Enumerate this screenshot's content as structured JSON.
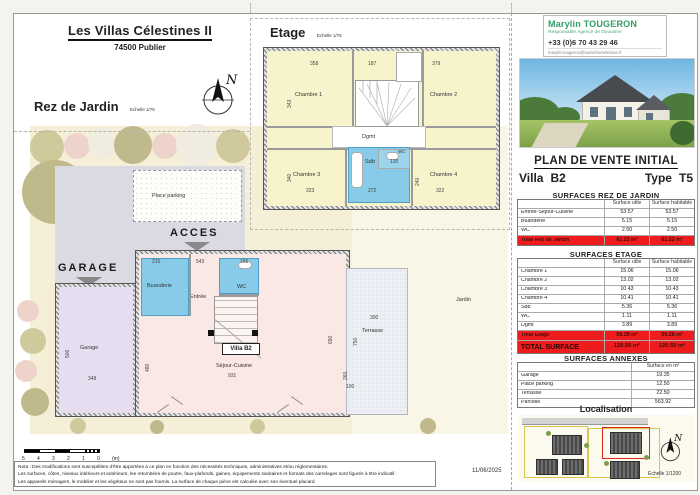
{
  "title": {
    "main": "Les Villas Célestines II",
    "sub": "74500 Publier"
  },
  "agent": {
    "name": "Marylin TOUGERON",
    "role": "Responsable Agence de Douvaine",
    "phone": "+33 (0)6 70 43 29 46",
    "email": "marylin.tougeron@sweethomeleman.fr"
  },
  "sale": {
    "heading": "PLAN DE VENTE INITIAL",
    "villa_label": "Villa",
    "villa_value": "B2",
    "type_label": "Type",
    "type_value": "T5"
  },
  "plans": {
    "rez": {
      "title": "Rez de Jardin",
      "scale": "Echelle 1/75"
    },
    "etage": {
      "title": "Etage",
      "scale": "Echelle 1/75"
    }
  },
  "etage": {
    "rooms": {
      "c1": "Chambre 1",
      "c2": "Chambre 2",
      "c3": "Chambre 3",
      "c4": "Chambre 4",
      "dgmt": "Dgmt",
      "sdb": "Sdb",
      "wc": "WC"
    },
    "dims": [
      {
        "t": "358",
        "x": 310,
        "y": 62
      },
      {
        "t": "187",
        "x": 368,
        "y": 62
      },
      {
        "t": "379",
        "x": 432,
        "y": 62
      },
      {
        "t": "323",
        "x": 306,
        "y": 189
      },
      {
        "t": "272",
        "x": 368,
        "y": 189
      },
      {
        "t": "322",
        "x": 436,
        "y": 189
      },
      {
        "t": "130",
        "x": 390,
        "y": 160
      },
      {
        "t": "343",
        "x": 288,
        "y": 108,
        "v": 1
      },
      {
        "t": "340",
        "x": 288,
        "y": 182,
        "v": 1
      },
      {
        "t": "240",
        "x": 416,
        "y": 186,
        "v": 1
      }
    ]
  },
  "rez": {
    "rooms": {
      "buanderie": "Buanderie",
      "entree": "Entrée",
      "wc": "WC",
      "garage": "Garage",
      "villa": "Villa B2",
      "sejour": "Séjour-Cuisine",
      "terrasse": "Terrasse",
      "jardin": "Jardin",
      "parking": "Place parking"
    },
    "callouts": {
      "acces": "ACCES",
      "garage": "GARAGE"
    },
    "dims": [
      {
        "t": "215",
        "x": 152,
        "y": 260
      },
      {
        "t": "543",
        "x": 196,
        "y": 260
      },
      {
        "t": "166",
        "x": 240,
        "y": 260
      },
      {
        "t": "931",
        "x": 228,
        "y": 374
      },
      {
        "t": "480",
        "x": 146,
        "y": 372,
        "v": 1
      },
      {
        "t": "690",
        "x": 329,
        "y": 344,
        "v": 1
      },
      {
        "t": "506",
        "x": 66,
        "y": 358,
        "v": 1
      },
      {
        "t": "348",
        "x": 88,
        "y": 377
      },
      {
        "t": "300",
        "x": 370,
        "y": 316
      },
      {
        "t": "750",
        "x": 354,
        "y": 346,
        "v": 1
      },
      {
        "t": "260",
        "x": 344,
        "y": 380,
        "v": 1
      },
      {
        "t": "100",
        "x": 346,
        "y": 385
      }
    ]
  },
  "compass": {
    "n": "N"
  },
  "tables": [
    {
      "title": "SURFACES REZ DE JARDIN",
      "headers": [
        "",
        "Surface utile",
        "Surface habitable"
      ],
      "rows": [
        [
          "Entrée-Séjour-Cuisine",
          "53.57",
          "53.57"
        ],
        [
          "Buanderie",
          "5.15",
          "5.15"
        ],
        [
          "WC",
          "2.50",
          "2.50"
        ]
      ],
      "totals": [
        {
          "cells": [
            "Total Rez de Jardin",
            "61.22 m²",
            "61.22 m²"
          ],
          "grand": false
        }
      ]
    },
    {
      "title": "SURFACES ETAGE",
      "headers": [
        "",
        "Surface utile",
        "Surface habitable"
      ],
      "rows": [
        [
          "Chambre 1",
          "15.06",
          "15.06"
        ],
        [
          "Chambre 2",
          "13.02",
          "13.02"
        ],
        [
          "Chambre 3",
          "10.43",
          "10.43"
        ],
        [
          "Chambre 4",
          "10.41",
          "10.41"
        ],
        [
          "Sdb",
          "5.36",
          "5.36"
        ],
        [
          "WC",
          "1.11",
          "1.11"
        ],
        [
          "Dgmt",
          "3.89",
          "3.89"
        ]
      ],
      "totals": [
        {
          "cells": [
            "Total Etage",
            "59.28 m²",
            "59.28 m²"
          ],
          "grand": false
        },
        {
          "cells": [
            "TOTAL SURFACE",
            "120.50 m²",
            "120.50 m²"
          ],
          "grand": true
        }
      ]
    },
    {
      "title": "SURFACES ANNEXES",
      "headers": [
        "",
        "Surface en m²"
      ],
      "rows": [
        [
          "Garage",
          "19.35"
        ],
        [
          "Place parking",
          "12.50"
        ],
        [
          "Terrasse",
          "22.50"
        ],
        [
          "Parcelle",
          "563.92"
        ]
      ],
      "totals": []
    }
  ],
  "localisation": {
    "title": "Localisation",
    "scale": "Echelle 1/1200"
  },
  "date": "11/06/2025",
  "ruler": {
    "labels": [
      "5",
      "4",
      "3",
      "2",
      "1",
      "0",
      "(m)"
    ]
  },
  "nota": {
    "l1": "Nota : Des modifications sont susceptibles d'être apportées à ce plan en fonction des nécessités techniques, administratives et/ou réglementaires.",
    "l2": "Les surfaces, côtes, niveaux intérieurs et extérieurs, les retombées de poutre, faux-plafonds, gaines, équipements sanitaires et formats des carrelages sont figurés à titre indicatif.",
    "l3": "Les appareils ménagers, le mobilier et les végétaux ne sont pas fournis. La surface de chaque pièce est calculée avec son éventuel placard."
  },
  "colors": {
    "accent_red": "#ee1c1c",
    "agent_green": "#2f9e68",
    "wet_blue": "#87cbe9",
    "room_yellow": "#f7f4cc"
  }
}
